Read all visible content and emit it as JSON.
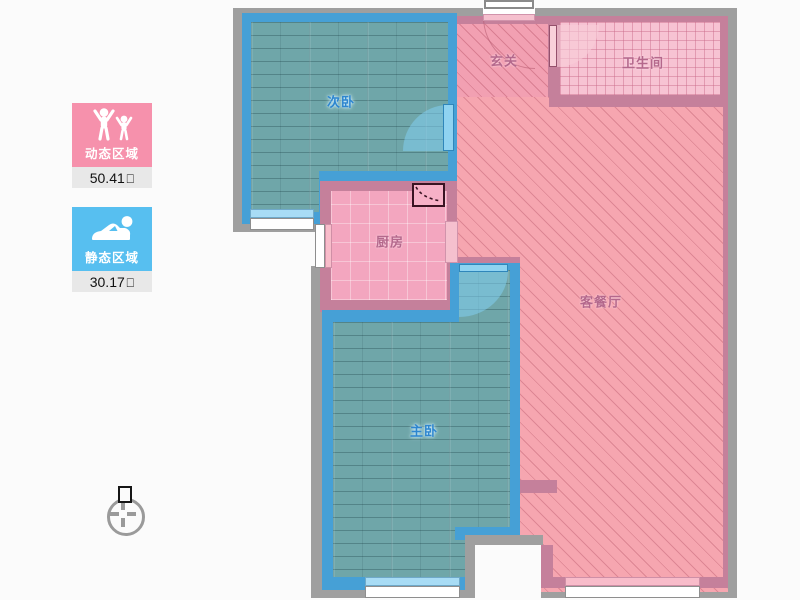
{
  "palette": {
    "dynamic_pink": "#f691ac",
    "static_blue": "#57bff0",
    "wall_gray": "#9f9f9f",
    "wall_mauve": "#c5809b",
    "wall_blue": "#46a0d6",
    "floor_teal": "#6fa6a9",
    "living_pink": "#f6a6b0",
    "kitchen_pink": "#f3a6bf",
    "bathroom_pink": "#f7c3d3",
    "door_blue": "#8fd3f1"
  },
  "legend": {
    "dynamic": {
      "label": "动态区域",
      "value": "50.41",
      "unit_glyph": "□",
      "icon": "people-icon",
      "color": "#f691ac"
    },
    "static": {
      "label": "静态区域",
      "value": "30.17",
      "unit_glyph": "□",
      "icon": "sleeper-icon",
      "color": "#57bff0"
    }
  },
  "rooms": {
    "secondary_bedroom": {
      "label": "次卧"
    },
    "hall": {
      "label": "玄关"
    },
    "bathroom": {
      "label": "卫生间"
    },
    "kitchen": {
      "label": "厨房"
    },
    "master_bedroom": {
      "label": "主卧"
    },
    "living_dining": {
      "label": "客餐厅"
    }
  }
}
